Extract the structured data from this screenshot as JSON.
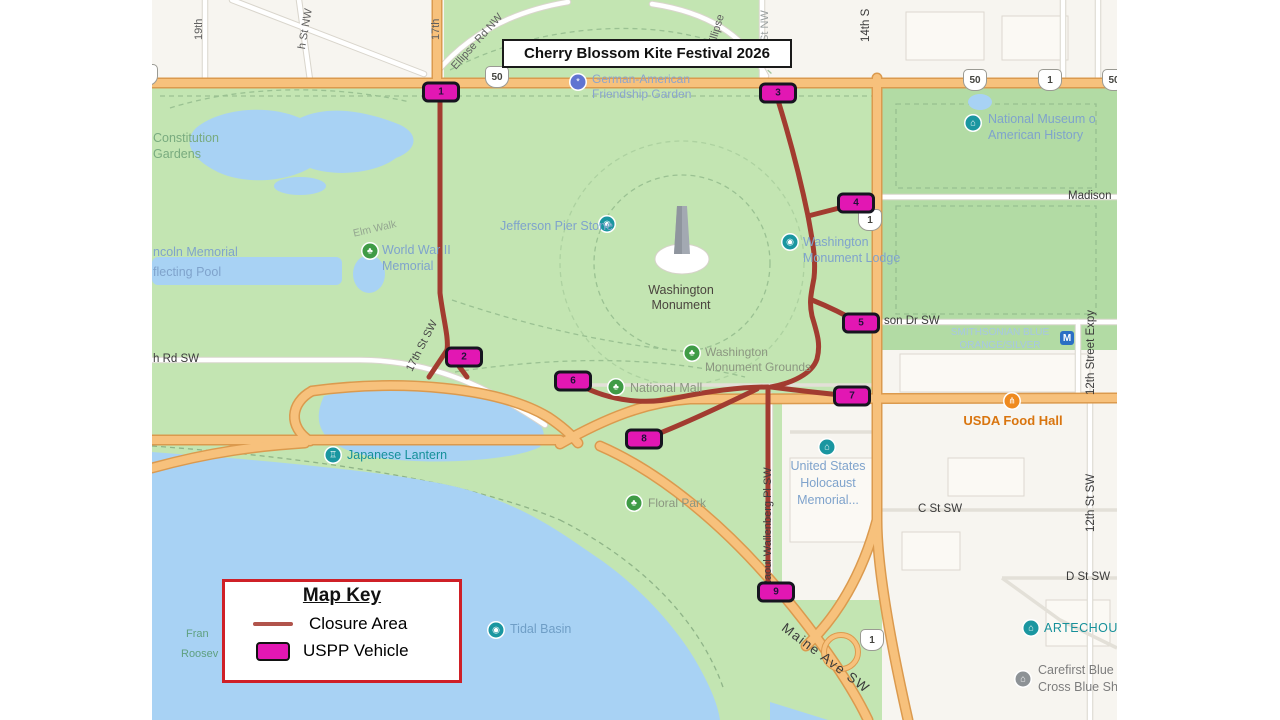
{
  "title_banner": {
    "text": "Cherry Blossom Kite Festival 2026"
  },
  "map_key": {
    "title": "Map Key",
    "closure": "Closure Area",
    "vehicle": "USPP Vehicle"
  },
  "markers": {
    "labels": [
      "1",
      "2",
      "3",
      "4",
      "5",
      "6",
      "7",
      "8",
      "9"
    ]
  },
  "streets": {
    "nineteenth": "19th",
    "eighteenth": "h St NW",
    "seventeenth": "17th",
    "ellipse_rd": "Ellipse Rd NW",
    "ellipse_rd_e": "Ellipse",
    "fifteenth": "St NW",
    "fourteenth": "14th S",
    "madison": "Madison",
    "jefferson": "son Dr SW",
    "twelfth_expy": "12th Street Expy",
    "twelfth_sw": "12th St SW",
    "c_st": "C St SW",
    "d_st": "D St SW",
    "rd_sw": "h Rd SW",
    "seventeenth_sw": "17th St SW",
    "raoul": "Raoul Wallenberg Pl SW",
    "maine": "Maine Ave SW",
    "elm_walk": "Elm Walk"
  },
  "pois": {
    "constitution_gardens": [
      "Constitution",
      "Gardens"
    ],
    "reflecting_pool": [
      "ncoln Memorial",
      "flecting Pool"
    ],
    "wwii": [
      "World War II",
      "Memorial"
    ],
    "jefferson_pier": "Jefferson Pier Stone",
    "monument": [
      "Washington",
      "Monument"
    ],
    "lodge": [
      "Washington",
      "Monument Lodge"
    ],
    "grounds": [
      "Washington",
      "Monument Grounds"
    ],
    "national_mall": "National Mall",
    "friendship_garden": [
      "German-American",
      "Friendship Garden"
    ],
    "american_history": [
      "National Museum o",
      "American History"
    ],
    "japanese_lantern": "Japanese Lantern",
    "floral_park": "Floral Park",
    "tidal_basin": "Tidal Basin",
    "holocaust": [
      "United States",
      "Holocaust",
      "Memorial..."
    ],
    "usda": "USDA Food Hall",
    "smithsonian": [
      "SMITHSONIAN BLUE",
      "ORANGE/SILVER"
    ],
    "metro_m": "M",
    "artechouse": "ARTECHOU",
    "carefirst": [
      "Carefirst Blue",
      "Cross Blue Shiel"
    ],
    "roosevelt": [
      "Fran",
      "Roosev"
    ]
  },
  "shields": {
    "fifty_left": "50",
    "fifty_mid": "50",
    "one_top": "1",
    "fifty_right": "50",
    "one_14th": "1",
    "one_maine": "1"
  },
  "colors": {
    "closure_line": "#a23c30",
    "uspp_vehicle": "#e217b3",
    "key_border": "#cf2027"
  }
}
